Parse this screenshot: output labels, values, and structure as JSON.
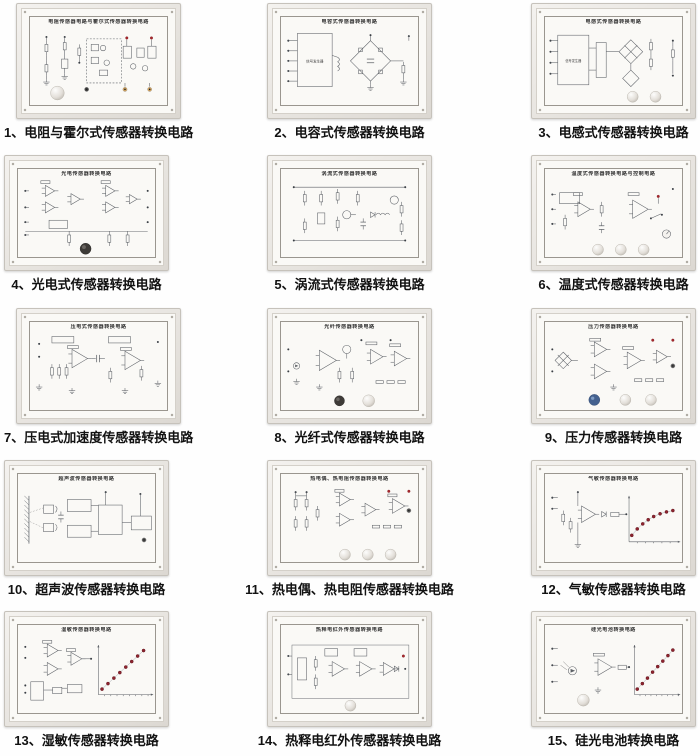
{
  "colors": {
    "led": "#8e2430",
    "indicator_red": "#a8262c",
    "terminal_yellow": "#d9a85f",
    "knob_blue": "#44618f",
    "knob_dark": "#3e3b38",
    "panel_face": "#faf9f6"
  },
  "board_labels": {
    "signal_generator": "信号发生器"
  },
  "panels": [
    {
      "caption": "1、电阻与霍尔式传感器转换电路",
      "title": "电阻传感器电路与霍尔式传感器转换电路",
      "kind": "res-hall"
    },
    {
      "caption": "2、电容式传感器转换电路",
      "title": "电容式传感器转换电路",
      "kind": "cap"
    },
    {
      "caption": "3、电感式传感器转换电路",
      "title": "电感式传感器转换电路",
      "kind": "ind"
    },
    {
      "caption": "4、光电式传感器转换电路",
      "title": "光电传感器转换电路",
      "kind": "photo"
    },
    {
      "caption": "5、涡流式传感器转换电路",
      "title": "涡流式传感器转换电路",
      "kind": "eddy"
    },
    {
      "caption": "6、温度式传感器转换电路",
      "title": "温度式传感器转换电路与控制电路",
      "kind": "temp"
    },
    {
      "caption": "7、压电式加速度传感器转换电路",
      "title": "压电式传感器转换电路",
      "kind": "piezo"
    },
    {
      "caption": "8、光纤式传感器转换电路",
      "title": "光纤传感器转换电路",
      "kind": "fiber"
    },
    {
      "caption": "9、压力传感器转换电路",
      "title": "压力传感器转换电路",
      "kind": "pressure"
    },
    {
      "caption": "10、超声波传感器转换电路",
      "title": "超声波传感器转换电路",
      "kind": "ultra"
    },
    {
      "caption": "11、热电偶、热电阻传感器转换电路",
      "title": "热电偶、热电阻传感器转换电路",
      "kind": "thermo"
    },
    {
      "caption": "12、气敏传感器转换电路",
      "title": "气敏传感器转换电路",
      "kind": "gas"
    },
    {
      "caption": "13、湿敏传感器转换电路",
      "title": "湿敏传感器转换电路",
      "kind": "hum"
    },
    {
      "caption": "14、热释电红外传感器转换电路",
      "title": "热释电红外传感器转换电路",
      "kind": "pyro"
    },
    {
      "caption": "15、硅光电池转换电路",
      "title": "硅光电池转换电路",
      "kind": "si"
    }
  ]
}
